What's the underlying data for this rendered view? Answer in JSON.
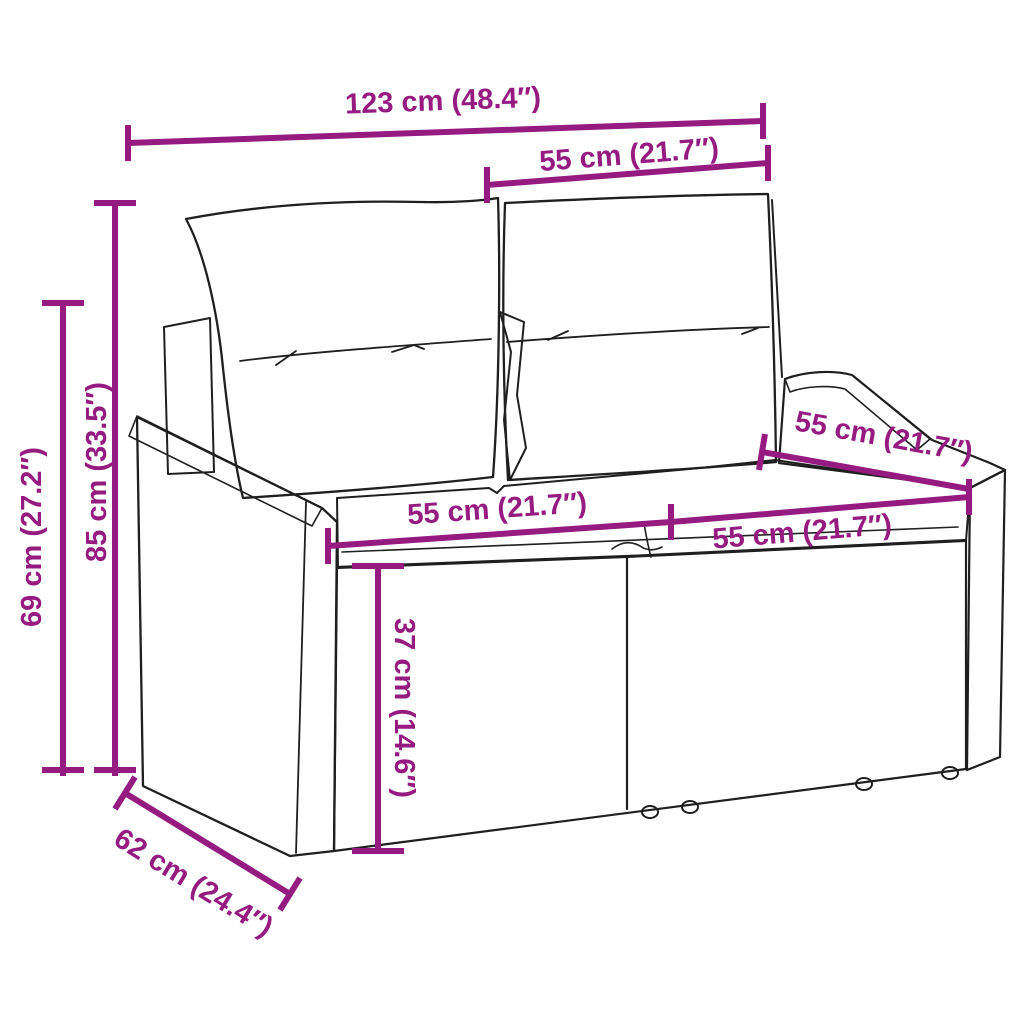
{
  "page": {
    "background": "#ffffff",
    "kind": "product-dimension-diagram",
    "subject": "2-seater poly rattan garden sofa with back and seat cushions"
  },
  "diagram": {
    "colors": {
      "dimension_accent": "#951b81",
      "drawing_outline": "#1f1f1f",
      "fill": "#ffffff"
    },
    "dimensions": {
      "overall_width": {
        "label": "123 cm (48.4″)"
      },
      "backrest_width": {
        "label": "55 cm (21.7″)"
      },
      "back_height": {
        "label": "85 cm (33.5″)"
      },
      "arm_height": {
        "label": "69 cm (27.2″)"
      },
      "seat_width_left": {
        "label": "55 cm (21.7″)"
      },
      "seat_width_right": {
        "label": "55 cm (21.7″)"
      },
      "seat_depth_top": {
        "label": "55 cm (21.7″)"
      },
      "seat_height": {
        "label": "37 cm (14.6″)"
      },
      "base_depth": {
        "label": "62 cm (24.4″)"
      }
    }
  }
}
